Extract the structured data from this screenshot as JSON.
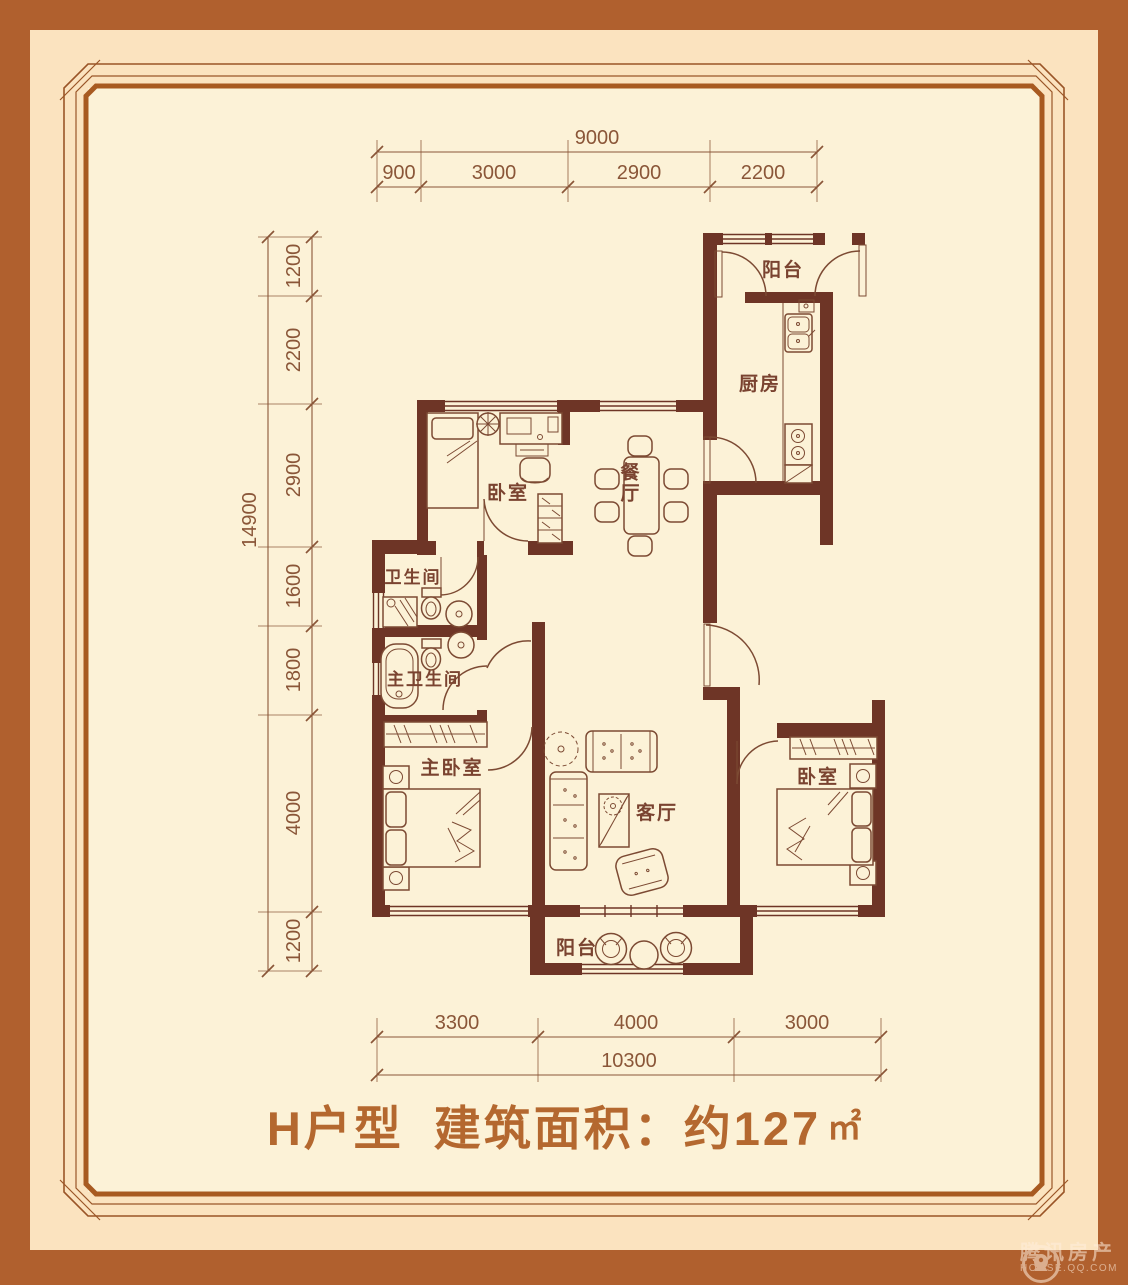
{
  "colors": {
    "frame": "#b0602e",
    "band": "#fbe3bf",
    "paper": "#fcf2d7",
    "wall": "#6e3526",
    "line": "#7c4a33",
    "label": "#7a4330",
    "dim": "#8a5638",
    "border": "#9a5527",
    "border-thick": "#a85a20",
    "title": "#b4682f",
    "watermark": "#ffeedd"
  },
  "plan": {
    "rooms": [
      {
        "id": "balcony-top",
        "label": "阳台"
      },
      {
        "id": "kitchen",
        "label": "厨房"
      },
      {
        "id": "dining",
        "label": "餐厅"
      },
      {
        "id": "bedroom-top",
        "label": "卧室"
      },
      {
        "id": "bathroom",
        "label": "卫生间"
      },
      {
        "id": "master-bathroom",
        "label": "主卫生间"
      },
      {
        "id": "master-bedroom",
        "label": "主卧室"
      },
      {
        "id": "living-room",
        "label": "客厅"
      },
      {
        "id": "bedroom-right",
        "label": "卧室"
      },
      {
        "id": "balcony-bottom",
        "label": "阳台"
      }
    ]
  },
  "dimensions": {
    "top": {
      "total": "9000",
      "segments": [
        "900",
        "3000",
        "2900",
        "2200"
      ]
    },
    "left": {
      "total": "14900",
      "segments": [
        "1200",
        "2200",
        "2900",
        "1600",
        "1800",
        "4000",
        "1200"
      ]
    },
    "bottom": {
      "total": "10300",
      "segments": [
        "3300",
        "4000",
        "3000"
      ]
    }
  },
  "title": {
    "unit_type": "H户型",
    "area_label": "建筑面积：约127",
    "area_unit": "㎡"
  },
  "watermark": {
    "cn": "腾讯房产",
    "en": "HOUSE.QQ.COM"
  }
}
